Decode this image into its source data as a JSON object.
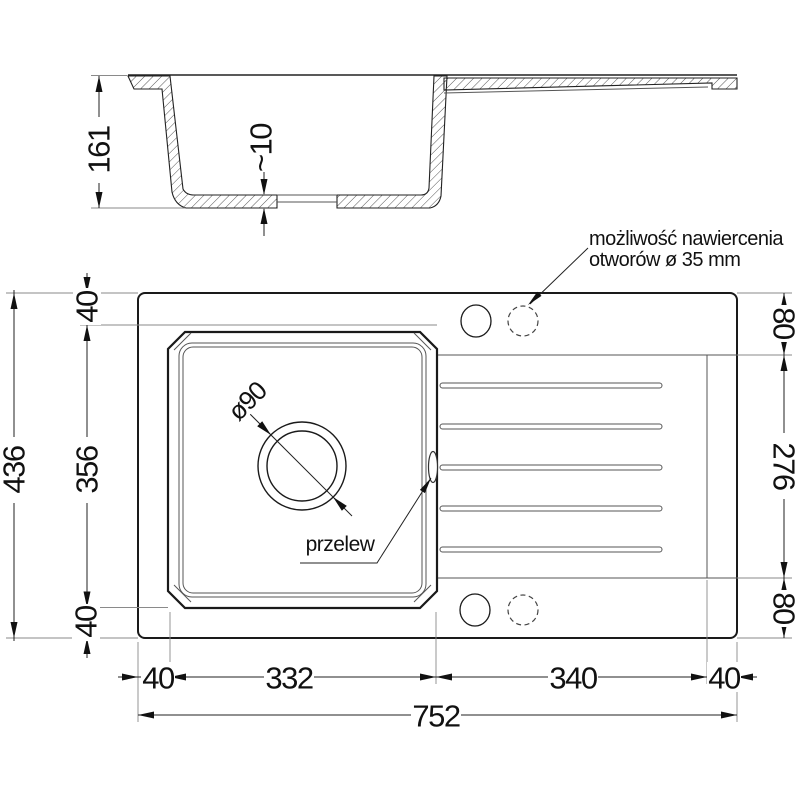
{
  "section": {
    "dim_height": "161",
    "dim_bottom_step": "~10"
  },
  "plan": {
    "dim_overall_height": "436",
    "dim_total_width": "752",
    "left_chain": {
      "top": "40",
      "middle": "356",
      "bottom": "40"
    },
    "right_chain": {
      "top": "80",
      "middle": "276",
      "bottom": "80"
    },
    "bottom_chain": {
      "left_margin": "40",
      "basin_width": "332",
      "drainer_width": "340",
      "right_margin": "40"
    },
    "drain_diameter": "ø90",
    "overflow_label": "przelew",
    "drill_note_line1": "możliwość nawiercenia",
    "drill_note_line2": "otworów ø 35 mm"
  }
}
